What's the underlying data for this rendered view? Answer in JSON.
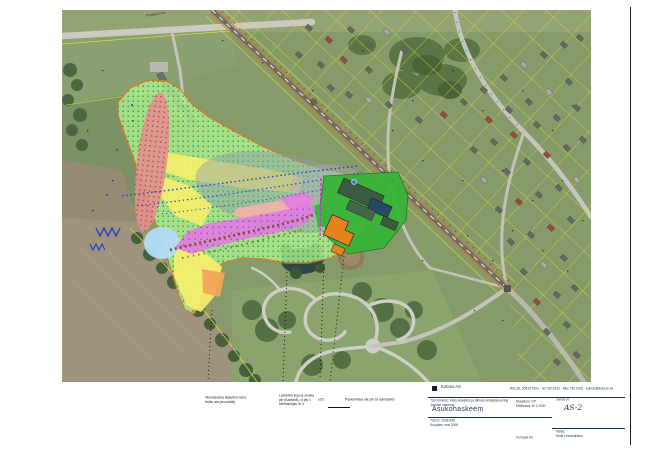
{
  "map": {
    "road_label": "Paldiski mnt"
  },
  "notes": {
    "a1": "Olemasoleva lasketiiru müra",
    "a2": "leviku ala (arvutuslik)",
    "b1": "Lasketiiru kuja ja ohuala",
    "b2": "piir (Kaitseliit), vt ptk 4",
    "b3": "seletuskirjas, lk 4",
    "legend_mark": "±0,0",
    "legend_text": "Planeeritava ala piir (vt seletuskiri)"
  },
  "title_block": {
    "company": "Kobras AS",
    "contact": "Riia 35, 50410 Tartu · tel 730 0310 · faks 730 0315 · kobras@kobras.ee",
    "project_label": "Töö nimetus:",
    "project": "Keila lasketiiru ja lähiala detailplaneering",
    "stage_label": "Staadium:",
    "stage": "DP",
    "scale_label": "Mõõtkava:",
    "scale": "M 1:2000",
    "drawing_label": "Joonise nimetus:",
    "title": "Asukohaskeem",
    "number_label": "Joonis nr:",
    "number": "AS-2",
    "work_label": "Töö nr:",
    "work_no": "2008-056",
    "date_label": "Kuupäev:",
    "date": "mai 2008",
    "client_label": "Tellija:",
    "client": "Keila Linnavalitsus",
    "format": "Formaat A3"
  }
}
